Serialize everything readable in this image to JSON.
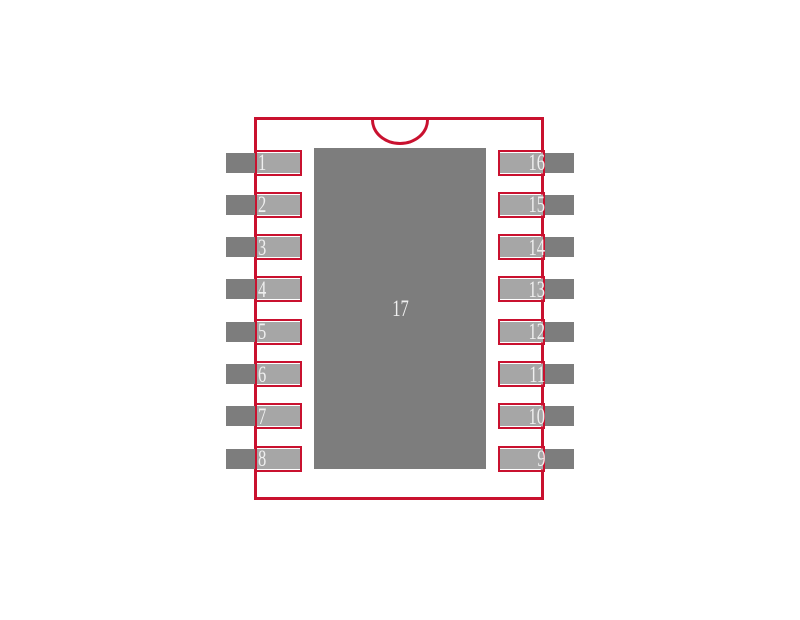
{
  "footprint": {
    "center_pad_number": "17",
    "left_pin_numbers": [
      "1",
      "2",
      "3",
      "4",
      "5",
      "6",
      "7",
      "8"
    ],
    "right_pin_numbers": [
      "16",
      "15",
      "14",
      "13",
      "12",
      "11",
      "10",
      "9"
    ]
  },
  "colors": {
    "outline_red": "#c9112f",
    "pad_gray": "#7d7d7d",
    "pad_highlight_overlay": "rgba(255,255,255,0.32)",
    "number_text": "#efefef",
    "background": "#ffffff"
  }
}
